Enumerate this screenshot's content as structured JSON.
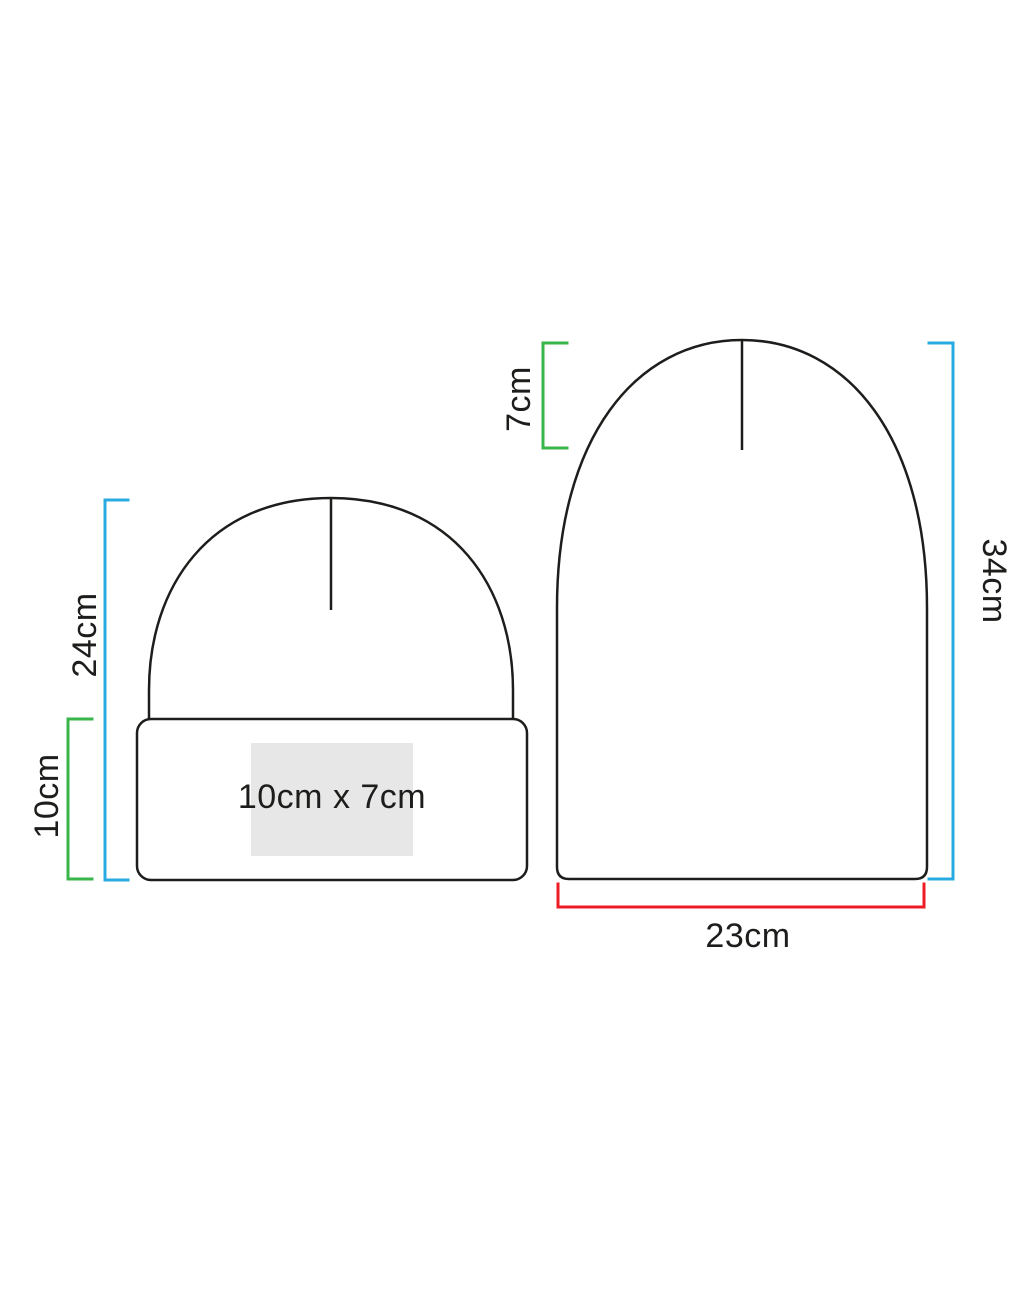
{
  "diagram": {
    "subject": "beanie-hat-size-specification",
    "left_beanie": {
      "name": "folded-cuff-beanie-front-view",
      "overall_height_label": "24cm",
      "cuff_height_label": "10cm",
      "print_area_label": "10cm x 7cm"
    },
    "right_beanie": {
      "name": "unfolded-beanie-side-view",
      "crown_depth_label": "7cm",
      "overall_height_label": "34cm",
      "width_label": "23cm"
    },
    "colors": {
      "outline": "#1d1d1b",
      "overall_height_bracket": "#29abe2",
      "secondary_bracket": "#39b54a",
      "width_bracket": "#ed1c24",
      "print_area_fill": "#e7e7e7",
      "background": "#ffffff"
    }
  }
}
